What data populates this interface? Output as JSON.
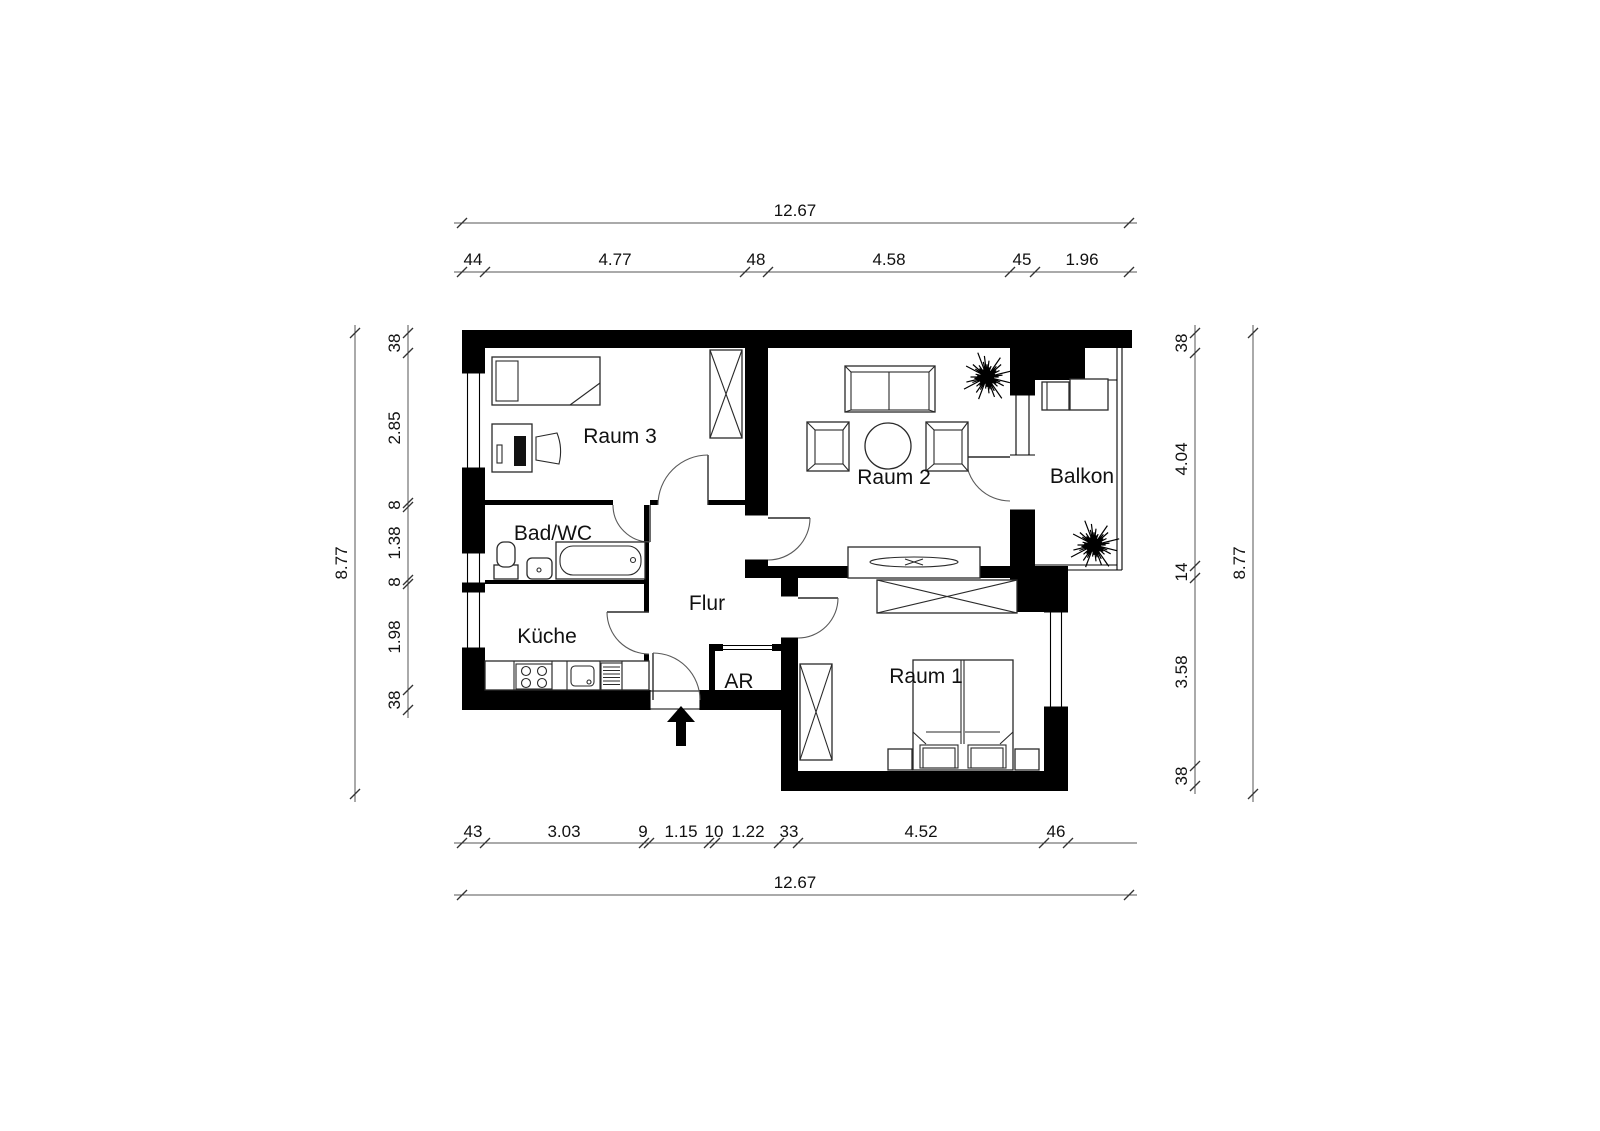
{
  "plan": {
    "title": "Wohnungsgrundriss",
    "rooms": {
      "raum3": "Raum 3",
      "raum2": "Raum 2",
      "raum1": "Raum 1",
      "balkon": "Balkon",
      "bad": "Bad/WC",
      "kueche": "Küche",
      "flur": "Flur",
      "ar": "AR"
    },
    "dims": {
      "top": {
        "total": "12.67",
        "segments": [
          "44",
          "4.77",
          "48",
          "4.58",
          "45",
          "1.96"
        ]
      },
      "bottom": {
        "total": "12.67",
        "segments": [
          "43",
          "3.03",
          "9",
          "1.15",
          "10",
          "1.22",
          "33",
          "4.52",
          "46"
        ]
      },
      "left": {
        "total": "8.77",
        "segments": [
          "38",
          "2.85",
          "8",
          "1.38",
          "8",
          "1.98",
          "38"
        ]
      },
      "right": {
        "total": "8.77",
        "segments": [
          "38",
          "4.04",
          "14",
          "3.58",
          "38"
        ]
      }
    },
    "colors": {
      "wall": "#000000",
      "line": "#555555",
      "background": "#ffffff"
    }
  }
}
